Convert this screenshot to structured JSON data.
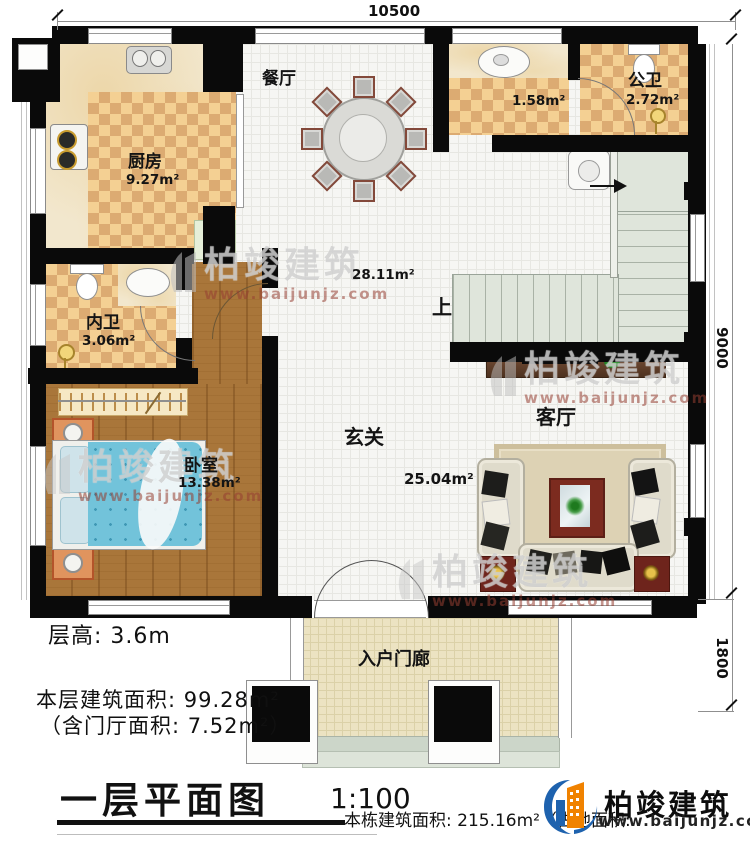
{
  "dimensions": {
    "top": "10500",
    "right_main": "9000",
    "right_porch": "1800"
  },
  "rooms": {
    "kitchen": {
      "name": "厨房",
      "area": "9.27m²"
    },
    "dining": {
      "name": "餐厅",
      "area": "28.11m²"
    },
    "wash": {
      "area": "1.58m²"
    },
    "public_bath": {
      "name": "公卫",
      "area": "2.72m²"
    },
    "private_bath": {
      "name": "内卫",
      "area": "3.06m²"
    },
    "bedroom": {
      "name": "卧室",
      "area": "13.38m²"
    },
    "foyer": {
      "name": "玄关",
      "area": "25.04m²"
    },
    "living": {
      "name": "客厅"
    },
    "porch": {
      "name": "入户门廊"
    },
    "stairs": {
      "up": "上"
    }
  },
  "annotations": {
    "floor_height": "层高: 3.6m",
    "floor_area": "本层建筑面积: 99.28m²",
    "hall_area": "（含门厅面积: 7.52m²）"
  },
  "title_block": {
    "title": "一层平面图",
    "scale": "1:100",
    "total_area_note": "本栋建筑面积: 215.16m²（占地面积:"
  },
  "brand": {
    "name": "柏竣建筑",
    "url": "www.baijunjz.com"
  },
  "watermark": {
    "name": "柏竣建筑",
    "url": "www.baijunjz.com"
  },
  "colors": {
    "wall": "#0a0a0a",
    "logo_blue": "#1e62ae",
    "logo_orange": "#f08200",
    "tile_dark": "#dcab72",
    "tile_light": "#f4d093"
  }
}
